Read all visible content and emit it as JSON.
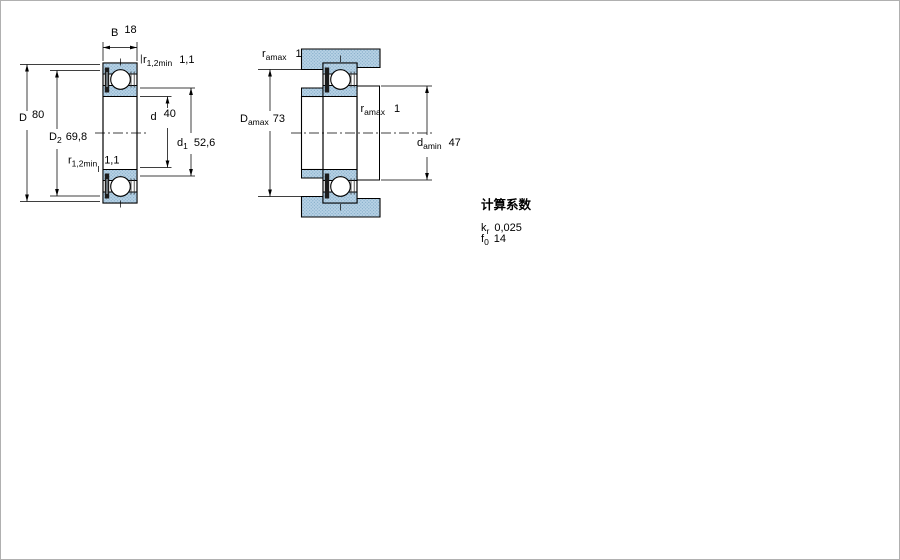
{
  "colors": {
    "section_fill": "#b9d3e6",
    "section_dot": "#84adca",
    "outline": "#000000",
    "frame": "#b0b0b0",
    "seal": "#1c1c1c"
  },
  "left_view": {
    "dim_B": {
      "sym": "B",
      "sub": "",
      "val": "18"
    },
    "dim_r12_top": {
      "sym": "r",
      "sub": "1,2min",
      "val": "1,1"
    },
    "dim_r12_bot": {
      "sym": "r",
      "sub": "1,2min",
      "val": "1,1"
    },
    "dim_D": {
      "sym": "D",
      "sub": "",
      "val": "80"
    },
    "dim_D2": {
      "sym": "D",
      "sub": "2",
      "val": "69,8"
    },
    "dim_d": {
      "sym": "d",
      "sub": "",
      "val": "40"
    },
    "dim_d1": {
      "sym": "d",
      "sub": "1",
      "val": "52,6"
    }
  },
  "right_view": {
    "dim_ramax_top": {
      "sym": "r",
      "sub": "amax",
      "val": "1"
    },
    "dim_ramax_mid": {
      "sym": "r",
      "sub": "amax",
      "val": "1"
    },
    "dim_Damax": {
      "sym": "D",
      "sub": "amax",
      "val": "73"
    },
    "dim_damin": {
      "sym": "d",
      "sub": "amin",
      "val": "47"
    }
  },
  "factors": {
    "title": "计算系数",
    "kr": {
      "sym": "k",
      "sub": "r",
      "val": "0,025"
    },
    "f0": {
      "sym": "f",
      "sub": "0",
      "val": "14"
    }
  }
}
